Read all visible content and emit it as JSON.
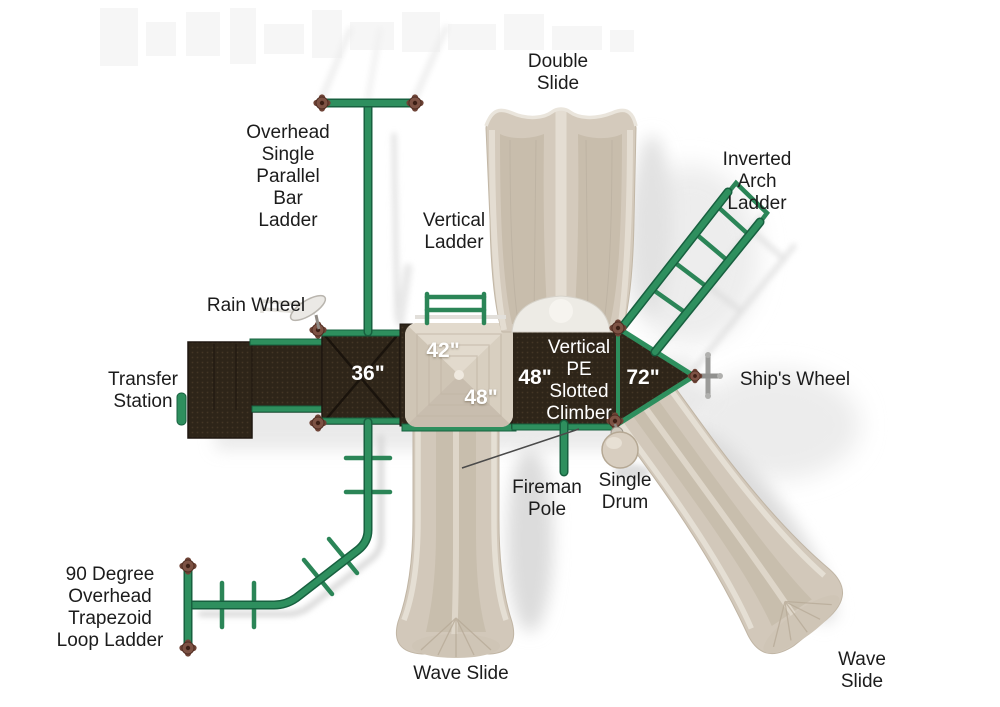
{
  "diagram_title": "Playground play structure top view diagram",
  "colors": {
    "rail_green": "#2e8f5e",
    "rail_green_dark": "#17603f",
    "deck_brown": "#2e2519",
    "plastic_tan": "#d4cabc",
    "connector_brown": "#7d5244",
    "label_text": "#1c1c1c",
    "measurement_text": "#ffffff"
  },
  "labels": {
    "double_slide": {
      "lines": [
        "Double",
        "Slide"
      ]
    },
    "overhead_single_parallel_bar_ladder": {
      "lines": [
        "Overhead",
        "Single",
        "Parallel",
        "Bar",
        "Ladder"
      ]
    },
    "vertical_ladder": {
      "lines": [
        "Vertical",
        "Ladder"
      ]
    },
    "inverted_arch_ladder": {
      "lines": [
        "Inverted",
        "Arch",
        "Ladder"
      ]
    },
    "rain_wheel": {
      "lines": [
        "Rain Wheel"
      ]
    },
    "transfer_station": {
      "lines": [
        "Transfer",
        "Station"
      ]
    },
    "ships_wheel": {
      "lines": [
        "Ship's Wheel"
      ]
    },
    "vertical_pe_slotted_climber": {
      "lines": [
        "Vertical",
        "PE",
        "Slotted",
        "Climber"
      ]
    },
    "fireman_pole": {
      "lines": [
        "Fireman",
        "Pole"
      ]
    },
    "single_drum": {
      "lines": [
        "Single",
        "Drum"
      ]
    },
    "loop_ladder_90": {
      "lines": [
        "90 Degree",
        "Overhead",
        "Trapezoid",
        "Loop Ladder"
      ]
    },
    "wave_slide_bottom": {
      "lines": [
        "Wave Slide"
      ]
    },
    "wave_slide_right": {
      "lines": [
        "Wave",
        "Slide"
      ]
    }
  },
  "measurements": {
    "deck_36": "36\"",
    "roof_42": "42\"",
    "roof_48": "48\"",
    "deck_48": "48\"",
    "deck_72": "72\""
  }
}
